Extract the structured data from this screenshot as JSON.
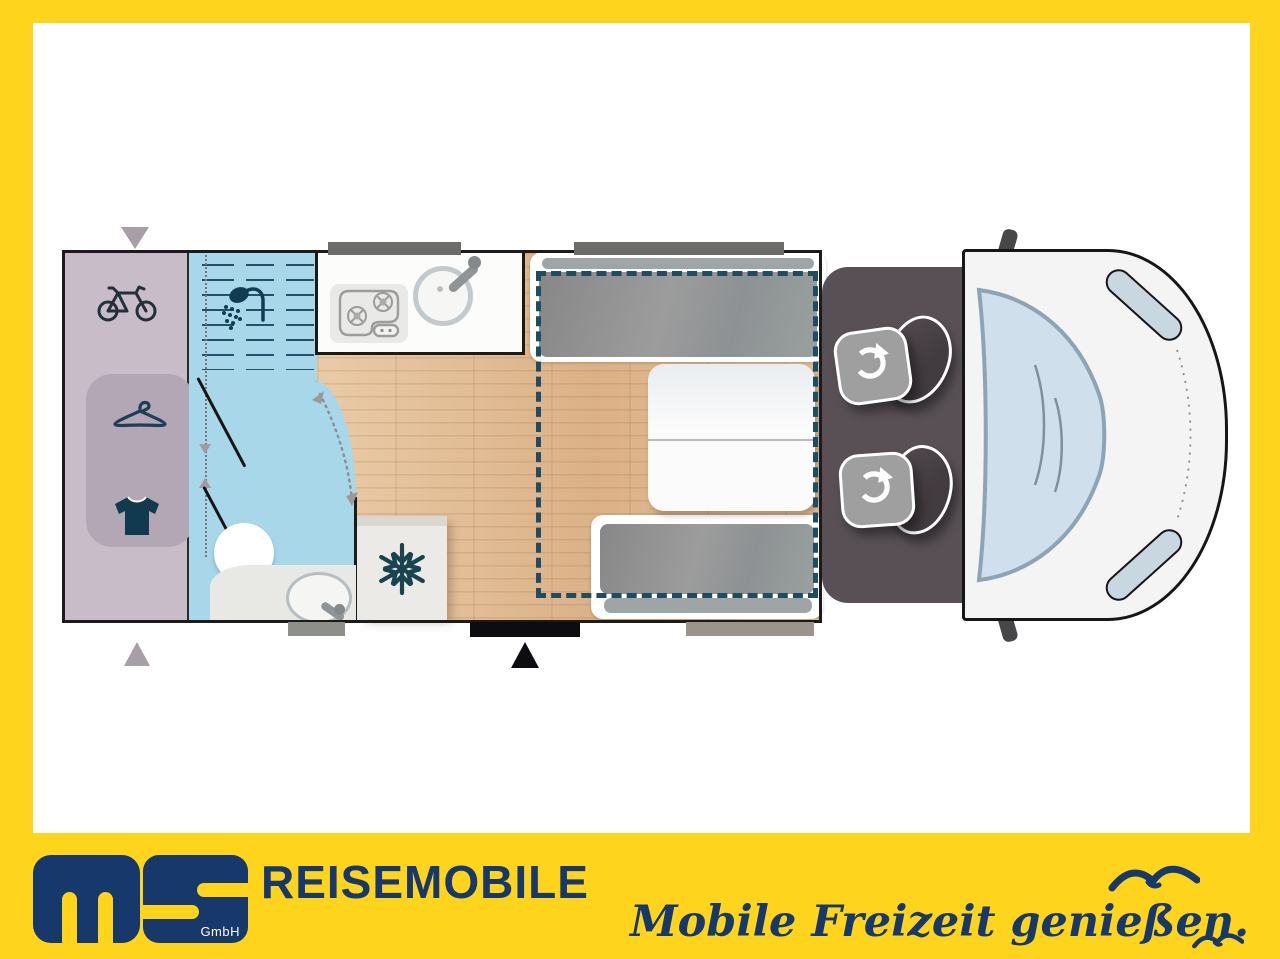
{
  "frame": {
    "color": "#ffd41d"
  },
  "canvas": {
    "bg": "#ffffff"
  },
  "branding": {
    "logo_letters": "MS",
    "gmbh_label": "GmbH",
    "company_label": "REISEMOBILE",
    "slogan": "Mobile Freizeit genießen.",
    "navy": "#16386b",
    "yellow": "#ffd41d"
  },
  "floorplan": {
    "type": "motorhome-top-view",
    "areas": {
      "rear_garage": {
        "color": "#c7bcc8",
        "icons": [
          "bicycle",
          "hanger",
          "tshirt"
        ]
      },
      "wardrobe": {
        "color": "#b3a7b5"
      },
      "shower": {
        "color": "#a7d7e9",
        "icon": "shower"
      },
      "bathroom": {
        "color": "#a7d7e9",
        "fixtures": [
          "toilet",
          "washbasin"
        ]
      },
      "kitchen": {
        "color": "#fcfcfb",
        "fixtures": [
          "two-burner-stove",
          "round-sink"
        ]
      },
      "fridge": {
        "color": "#eceae6",
        "icon": "snowflake"
      },
      "dinette": {
        "fixtures": [
          "bench-seat-front",
          "table",
          "bench-seat-rear"
        ]
      },
      "drop_down_bed": {
        "outline_color": "#1e4c61",
        "style": "dashed"
      },
      "cab": {
        "color": "#585055",
        "fixtures": [
          "swivel-seat-driver",
          "swivel-seat-passenger"
        ]
      },
      "vehicle_front": {
        "fixtures": [
          "windshield",
          "headlight-left",
          "headlight-right",
          "mirror-left",
          "mirror-right"
        ]
      },
      "floor": {
        "color": "#e0bb93"
      }
    },
    "markers": [
      "entry-door",
      "garage-door-arrows",
      "window-bars"
    ]
  }
}
